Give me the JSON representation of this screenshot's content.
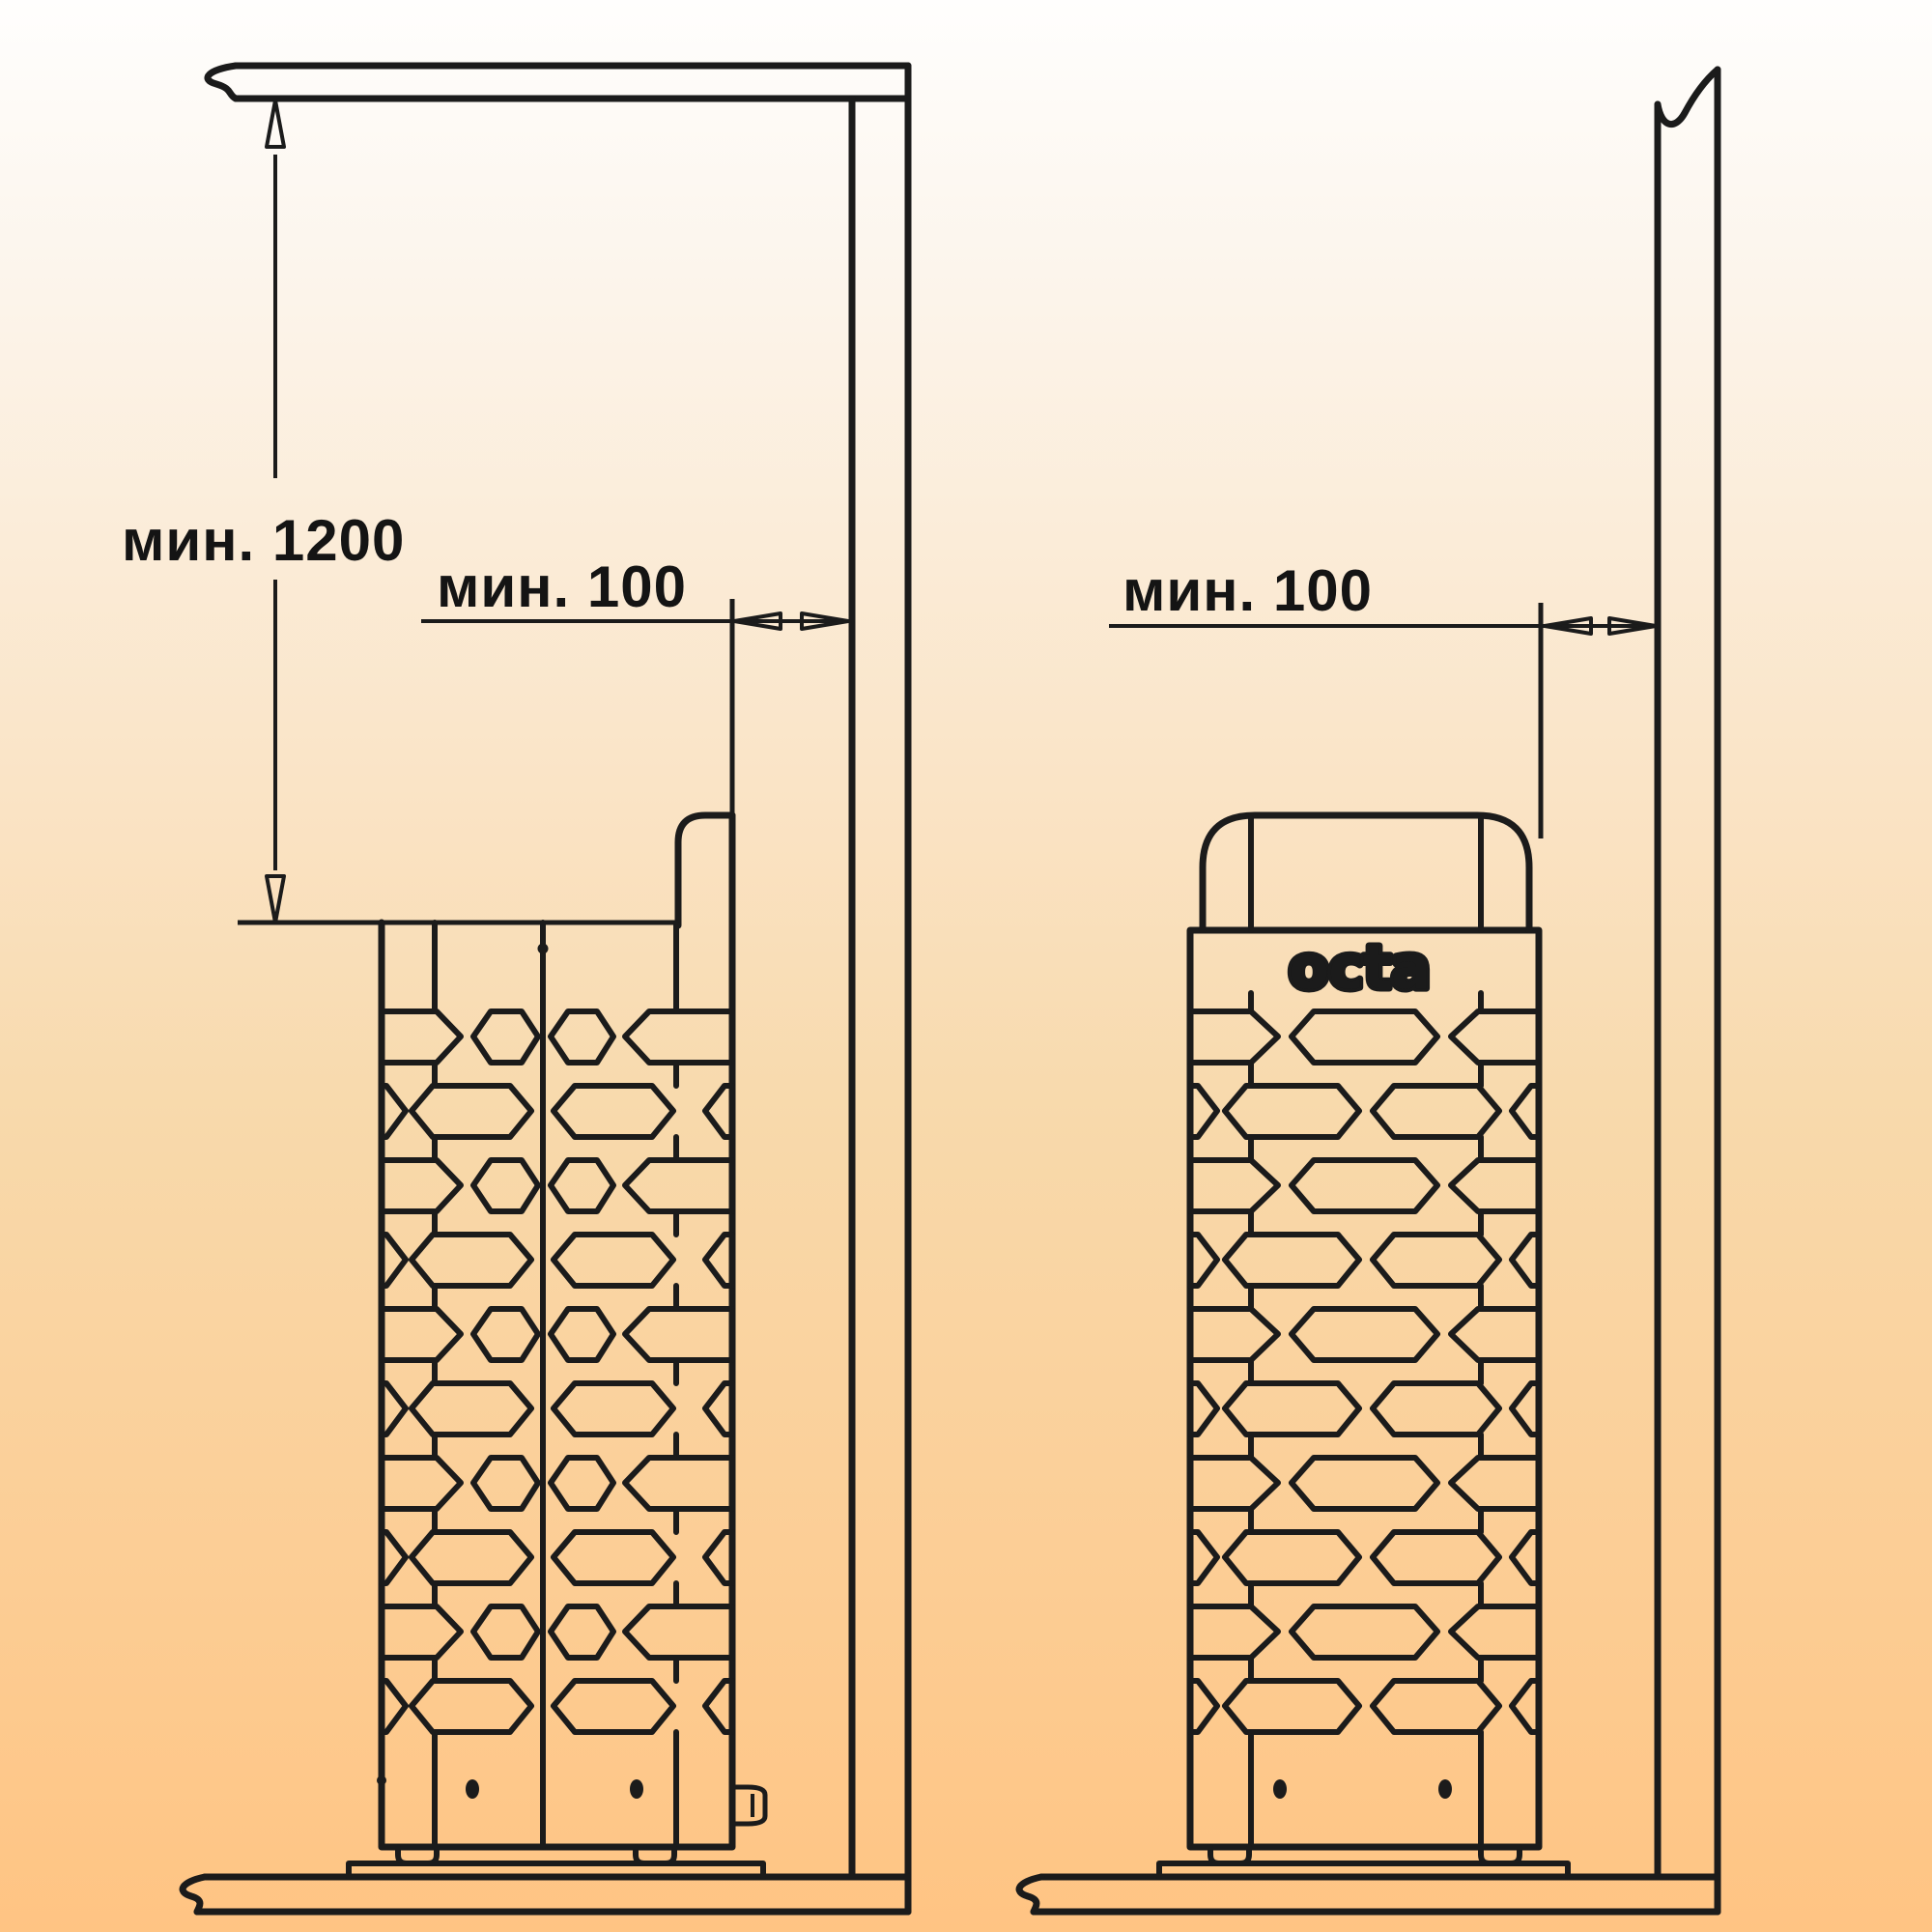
{
  "page": {
    "description": "Sauna heater installation clearance diagram, side view and front view"
  },
  "labels": {
    "min_ceiling_clearance": "мин. 1200",
    "min_wall_clearance_side": "мин. 100",
    "min_wall_clearance_front": "мин. 100"
  },
  "brand": {
    "logo": "octa"
  },
  "colors": {
    "line": "#1b1b1b",
    "text": "#141414",
    "background_top": "#fffefd",
    "background_bottom": "#ffc483"
  }
}
